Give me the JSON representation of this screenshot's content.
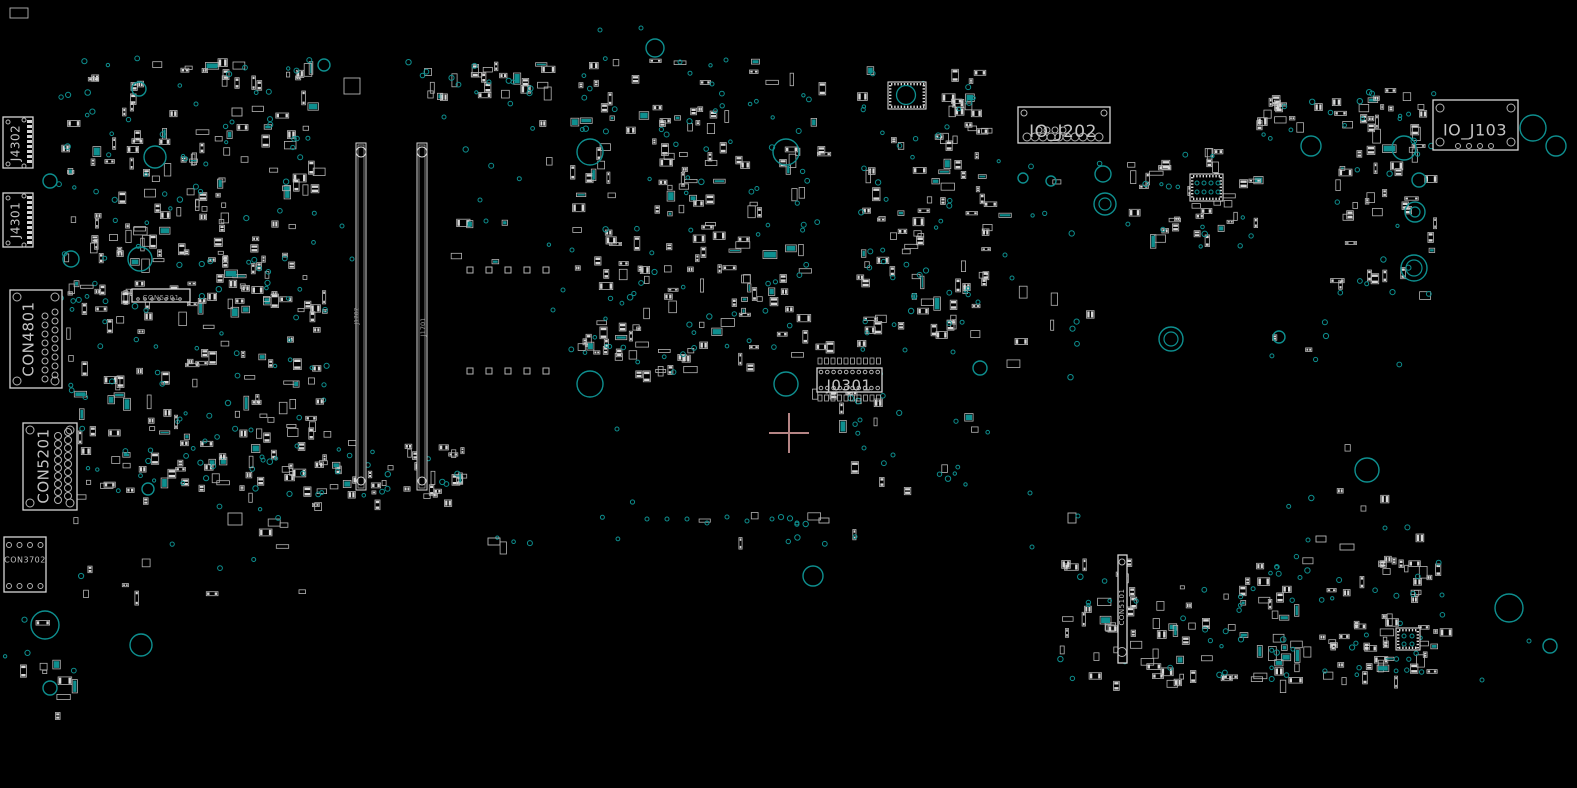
{
  "board": {
    "width": 1577,
    "height": 788,
    "colors": {
      "bg": "#000000",
      "outline": "#b4b4b4",
      "bright": "#d6d6d6",
      "pad": "#d8d8d8",
      "via": "#0e8f8f",
      "label": "#c4c4c4",
      "dim_label": "#9b9b9b"
    },
    "crosshair": {
      "x": 789,
      "y": 433,
      "arm": 20,
      "color": "#b58585"
    }
  },
  "connectors": [
    {
      "ref": "J4302",
      "label": "J4302",
      "box": [
        3,
        117,
        30,
        51
      ],
      "orient": "v",
      "font": 12,
      "label_pos": [
        16,
        143
      ],
      "pads": [
        {
          "t": "rcol",
          "x": 27,
          "y0": 120,
          "dy": 5,
          "n": 9,
          "w": 5,
          "h": 3
        },
        {
          "t": "circles",
          "r": 2,
          "pts": [
            [
              8,
              122
            ],
            [
              24,
              120
            ],
            [
              8,
              164
            ],
            [
              24,
              166
            ]
          ]
        }
      ]
    },
    {
      "ref": "J4301",
      "label": "J4301",
      "box": [
        3,
        193,
        30,
        54
      ],
      "orient": "v",
      "font": 12,
      "label_pos": [
        16,
        220
      ],
      "pads": [
        {
          "t": "rcol",
          "x": 27,
          "y0": 196,
          "dy": 5,
          "n": 10,
          "w": 5,
          "h": 3
        },
        {
          "t": "circles",
          "r": 2,
          "pts": [
            [
              8,
              198
            ],
            [
              24,
              196
            ],
            [
              8,
              243
            ],
            [
              24,
              245
            ]
          ]
        }
      ]
    },
    {
      "ref": "CON4801",
      "label": "CON4801",
      "box": [
        10,
        290,
        52,
        98
      ],
      "orient": "v",
      "font": 15,
      "label_pos": [
        29,
        339
      ],
      "pads": [
        {
          "t": "circles",
          "r": 4,
          "pts": [
            [
              17,
              297
            ],
            [
              55,
              297
            ],
            [
              17,
              381
            ],
            [
              55,
              381
            ]
          ]
        },
        {
          "t": "col",
          "x": 45,
          "y0": 316,
          "dy": 9,
          "n": 8,
          "r": 3
        },
        {
          "t": "col",
          "x": 55,
          "y0": 312,
          "dy": 9,
          "n": 8,
          "r": 3
        }
      ]
    },
    {
      "ref": "CON5201",
      "label": "CON5201",
      "box": [
        23,
        423,
        54,
        87
      ],
      "orient": "v",
      "font": 15,
      "label_pos": [
        44,
        466
      ],
      "pads": [
        {
          "t": "circles",
          "r": 4,
          "pts": [
            [
              30,
              430
            ],
            [
              70,
              430
            ],
            [
              30,
              503
            ],
            [
              70,
              503
            ]
          ]
        },
        {
          "t": "col",
          "x": 58,
          "y0": 436,
          "dy": 8,
          "n": 9,
          "r": 3.5
        },
        {
          "t": "col",
          "x": 68,
          "y0": 432,
          "dy": 8,
          "n": 9,
          "r": 3.5
        }
      ]
    },
    {
      "ref": "CON3702",
      "label": "CON3702",
      "box": [
        4,
        537,
        42,
        55
      ],
      "orient": "h",
      "font": 8,
      "label_pos": [
        25,
        560
      ],
      "pads": [
        {
          "t": "row",
          "y": 545,
          "x0": 9,
          "dx": 10.5,
          "n": 4,
          "r": 2.5
        },
        {
          "t": "row",
          "y": 586,
          "x0": 9,
          "dx": 10.5,
          "n": 4,
          "r": 2.5
        }
      ]
    },
    {
      "ref": "CON5301",
      "label": "CON5301",
      "box": [
        132,
        289,
        58,
        13
      ],
      "orient": "h",
      "font": 7,
      "dim": true,
      "label_pos": [
        161,
        298
      ],
      "pads": [
        {
          "t": "row",
          "y": 299,
          "x0": 138,
          "dx": 7,
          "n": 7,
          "r": 1.3
        }
      ]
    },
    {
      "ref": "J0301",
      "label": "J0301",
      "box": [
        817,
        368,
        65,
        24
      ],
      "orient": "h",
      "font": 15,
      "label_pos": [
        849,
        386
      ],
      "pads": [
        {
          "t": "row",
          "y": 372,
          "x0": 821,
          "dx": 6.3,
          "n": 10,
          "r": 1.8
        },
        {
          "t": "row",
          "y": 388,
          "x0": 821,
          "dx": 6.3,
          "n": 10,
          "r": 1.8
        },
        {
          "t": "rrow",
          "y": 358,
          "x0": 818,
          "dx": 6.5,
          "n": 10,
          "w": 4,
          "h": 6
        },
        {
          "t": "rrow",
          "y": 395,
          "x0": 818,
          "dx": 6.5,
          "n": 10,
          "w": 4,
          "h": 6
        }
      ]
    },
    {
      "ref": "IO_J202",
      "label": "IO_J202",
      "box": [
        1018,
        107,
        92,
        36
      ],
      "orient": "h",
      "font": 17,
      "label_pos": [
        1063,
        132
      ],
      "pads": [
        {
          "t": "circles",
          "r": 3,
          "pts": [
            [
              1024,
              113
            ],
            [
              1104,
              113
            ]
          ]
        },
        {
          "t": "row",
          "y": 137,
          "x0": 1027,
          "dx": 8,
          "n": 10,
          "r": 4
        },
        {
          "t": "row",
          "y": 130,
          "x0": 1039,
          "dx": 8,
          "n": 4,
          "r": 3
        }
      ]
    },
    {
      "ref": "IO_J103",
      "label": "IO_J103",
      "box": [
        1433,
        100,
        85,
        50
      ],
      "orient": "h",
      "font": 16,
      "label_pos": [
        1475,
        131
      ],
      "pads": [
        {
          "t": "circles",
          "r": 4,
          "pts": [
            [
              1440,
              108
            ],
            [
              1511,
              108
            ],
            [
              1440,
              142
            ],
            [
              1511,
              142
            ]
          ]
        },
        {
          "t": "row",
          "y": 146,
          "x0": 1458,
          "dx": 11,
          "n": 4,
          "r": 2.5
        }
      ]
    },
    {
      "ref": "CON5101",
      "label": "CON5101",
      "box": [
        1118,
        555,
        9,
        108
      ],
      "orient": "v",
      "font": 7,
      "label_pos": [
        1122,
        607
      ],
      "pads": [
        {
          "t": "circles",
          "r": 3,
          "pts": [
            [
              1122,
              562
            ]
          ]
        },
        {
          "t": "circles",
          "r": 4.5,
          "pts": [
            [
              1122,
              652
            ]
          ]
        }
      ]
    }
  ],
  "slots": [
    {
      "ref": "slot-left",
      "label": "J1702",
      "x": 356,
      "y": 143,
      "w": 10,
      "h": 347,
      "label_pos": [
        357,
        316
      ],
      "font": 6
    },
    {
      "ref": "slot-right",
      "label": "J1701",
      "x": 417,
      "y": 143,
      "w": 10,
      "h": 347,
      "label_pos": [
        423,
        327
      ],
      "font": 6.5
    }
  ],
  "ics": [
    {
      "ref": "chip-with-thermal-ring",
      "box": [
        888,
        82,
        38,
        27
      ],
      "circle": [
        906,
        95,
        9.5
      ]
    },
    {
      "ref": "qfn-chip",
      "box": [
        1190,
        174,
        33,
        27
      ],
      "dots": [
        [
          1197,
          183
        ],
        [
          1204,
          183
        ],
        [
          1211,
          183
        ],
        [
          1218,
          183
        ],
        [
          1197,
          192
        ],
        [
          1204,
          192
        ],
        [
          1211,
          192
        ],
        [
          1218,
          192
        ]
      ]
    },
    {
      "ref": "qfn-chip-bottom-right",
      "box": [
        1396,
        628,
        24,
        22
      ],
      "dots": [
        [
          1404,
          636
        ],
        [
          1412,
          636
        ],
        [
          1404,
          644
        ],
        [
          1412,
          644
        ]
      ]
    }
  ],
  "mount_holes": [
    [
      655,
      48,
      9
    ],
    [
      139,
      89,
      7
    ],
    [
      324,
      65,
      6
    ],
    [
      155,
      157,
      11
    ],
    [
      50,
      181,
      7
    ],
    [
      71,
      259,
      8
    ],
    [
      140,
      259,
      12
    ],
    [
      590,
      152,
      13
    ],
    [
      786,
      152,
      13
    ],
    [
      590,
      384,
      13
    ],
    [
      786,
      384,
      12
    ],
    [
      1023,
      178,
      5
    ],
    [
      1051,
      181,
      5
    ],
    [
      1103,
      174,
      8
    ],
    [
      1311,
      146,
      10
    ],
    [
      1404,
      148,
      12
    ],
    [
      1419,
      180,
      7
    ],
    [
      1279,
      337,
      6
    ],
    [
      1367,
      470,
      12
    ],
    [
      1509,
      608,
      14
    ],
    [
      1550,
      646,
      7
    ],
    [
      813,
      576,
      10
    ],
    [
      1533,
      128,
      13
    ],
    [
      1556,
      146,
      10
    ],
    [
      45,
      625,
      14
    ],
    [
      141,
      645,
      11
    ],
    [
      50,
      688,
      7
    ],
    [
      148,
      489,
      6
    ],
    [
      980,
      368,
      7
    ]
  ],
  "rings": [
    [
      1105,
      204,
      11,
      6
    ],
    [
      1171,
      339,
      12,
      7
    ],
    [
      1414,
      268,
      13,
      8
    ],
    [
      1415,
      212,
      10,
      5
    ]
  ],
  "pad_squares": [
    [
      467,
      267
    ],
    [
      486,
      267
    ],
    [
      505,
      267
    ],
    [
      524,
      267
    ],
    [
      543,
      267
    ],
    [
      467,
      368
    ],
    [
      486,
      368
    ],
    [
      505,
      368
    ],
    [
      524,
      368
    ],
    [
      543,
      368
    ]
  ],
  "clusters": [
    {
      "x": 55,
      "y": 58,
      "w": 260,
      "h": 250,
      "n": 150,
      "seed": 1
    },
    {
      "x": 62,
      "y": 282,
      "w": 268,
      "h": 222,
      "n": 130,
      "seed": 2
    },
    {
      "x": 568,
      "y": 58,
      "w": 252,
      "h": 310,
      "n": 150,
      "seed": 3
    },
    {
      "x": 855,
      "y": 62,
      "w": 130,
      "h": 272,
      "n": 90,
      "seed": 4
    },
    {
      "x": 1125,
      "y": 148,
      "w": 135,
      "h": 100,
      "n": 40,
      "seed": 5
    },
    {
      "x": 1330,
      "y": 88,
      "w": 105,
      "h": 207,
      "n": 45,
      "seed": 6
    },
    {
      "x": 1060,
      "y": 556,
      "w": 385,
      "h": 126,
      "n": 125,
      "seed": 7
    },
    {
      "x": 330,
      "y": 438,
      "w": 145,
      "h": 62,
      "n": 32,
      "seed": 8
    },
    {
      "x": 398,
      "y": 62,
      "w": 150,
      "h": 34,
      "n": 22,
      "seed": 9
    },
    {
      "x": 578,
      "y": 336,
      "w": 130,
      "h": 38,
      "n": 18,
      "seed": 10
    },
    {
      "x": 806,
      "y": 336,
      "w": 80,
      "h": 100,
      "n": 16,
      "seed": 11
    },
    {
      "x": 1255,
      "y": 92,
      "w": 60,
      "h": 48,
      "n": 12,
      "seed": 12
    },
    {
      "x": 1355,
      "y": 92,
      "w": 45,
      "h": 35,
      "n": 8,
      "seed": 13
    }
  ],
  "sparse_regions": [
    {
      "x": 470,
      "y": 500,
      "w": 400,
      "h": 45,
      "n": 6,
      "vias": 14,
      "seed": 31
    },
    {
      "x": 850,
      "y": 400,
      "w": 140,
      "h": 110,
      "n": 6,
      "vias": 10,
      "seed": 32
    },
    {
      "x": 990,
      "y": 150,
      "w": 110,
      "h": 230,
      "n": 8,
      "vias": 10,
      "seed": 33
    },
    {
      "x": 1270,
      "y": 300,
      "w": 150,
      "h": 250,
      "n": 7,
      "vias": 8,
      "seed": 34
    },
    {
      "x": 150,
      "y": 395,
      "w": 175,
      "h": 115,
      "n": 9,
      "vias": 8,
      "seed": 35
    },
    {
      "x": 60,
      "y": 505,
      "w": 250,
      "h": 90,
      "n": 12,
      "vias": 6,
      "seed": 36
    },
    {
      "x": 430,
      "y": 100,
      "w": 120,
      "h": 160,
      "n": 7,
      "vias": 6,
      "seed": 37
    },
    {
      "x": 5,
      "y": 598,
      "w": 70,
      "h": 135,
      "n": 9,
      "vias": 4,
      "seed": 38
    },
    {
      "x": 1380,
      "y": 612,
      "w": 60,
      "h": 60,
      "n": 8,
      "vias": 6,
      "seed": 39
    }
  ],
  "sparse_parts": [
    [
      10,
      8,
      18,
      10
    ],
    [
      344,
      78,
      16,
      16
    ],
    [
      228,
      513,
      14,
      12
    ],
    [
      488,
      538,
      12,
      7
    ],
    [
      1316,
      536,
      10,
      6
    ],
    [
      1340,
      544,
      14,
      6
    ],
    [
      819,
      518,
      10,
      5
    ],
    [
      1068,
      513,
      8,
      10
    ],
    [
      232,
      108,
      10,
      8
    ]
  ],
  "sparse_vias": [
    [
      196,
      104
    ],
    [
      232,
      122
    ],
    [
      444,
      117
    ],
    [
      489,
      82
    ],
    [
      513,
      82
    ],
    [
      600,
      30
    ],
    [
      641,
      28
    ],
    [
      680,
      62
    ],
    [
      712,
      84
    ],
    [
      726,
      60
    ],
    [
      180,
      419
    ],
    [
      205,
      441
    ],
    [
      251,
      430
    ],
    [
      262,
      457
    ],
    [
      297,
      446
    ],
    [
      480,
      200
    ],
    [
      486,
      221
    ],
    [
      553,
      310
    ],
    [
      563,
      290
    ],
    [
      617,
      429
    ],
    [
      647,
      519
    ],
    [
      667,
      519
    ],
    [
      687,
      519
    ],
    [
      707,
      523
    ],
    [
      727,
      517
    ],
    [
      747,
      521
    ],
    [
      772,
      519
    ],
    [
      797,
      523
    ],
    [
      864,
      448
    ],
    [
      893,
      455
    ],
    [
      860,
      420
    ],
    [
      1030,
      493
    ],
    [
      1032,
      547
    ],
    [
      1078,
      516
    ],
    [
      1308,
      540
    ],
    [
      1385,
      528
    ],
    [
      1442,
      595
    ],
    [
      1482,
      680
    ],
    [
      1529,
      641
    ],
    [
      342,
      226
    ],
    [
      352,
      259
    ],
    [
      572,
      250
    ],
    [
      905,
      350
    ],
    [
      953,
      352
    ],
    [
      1005,
      255
    ],
    [
      1012,
      278
    ],
    [
      978,
      302
    ]
  ]
}
